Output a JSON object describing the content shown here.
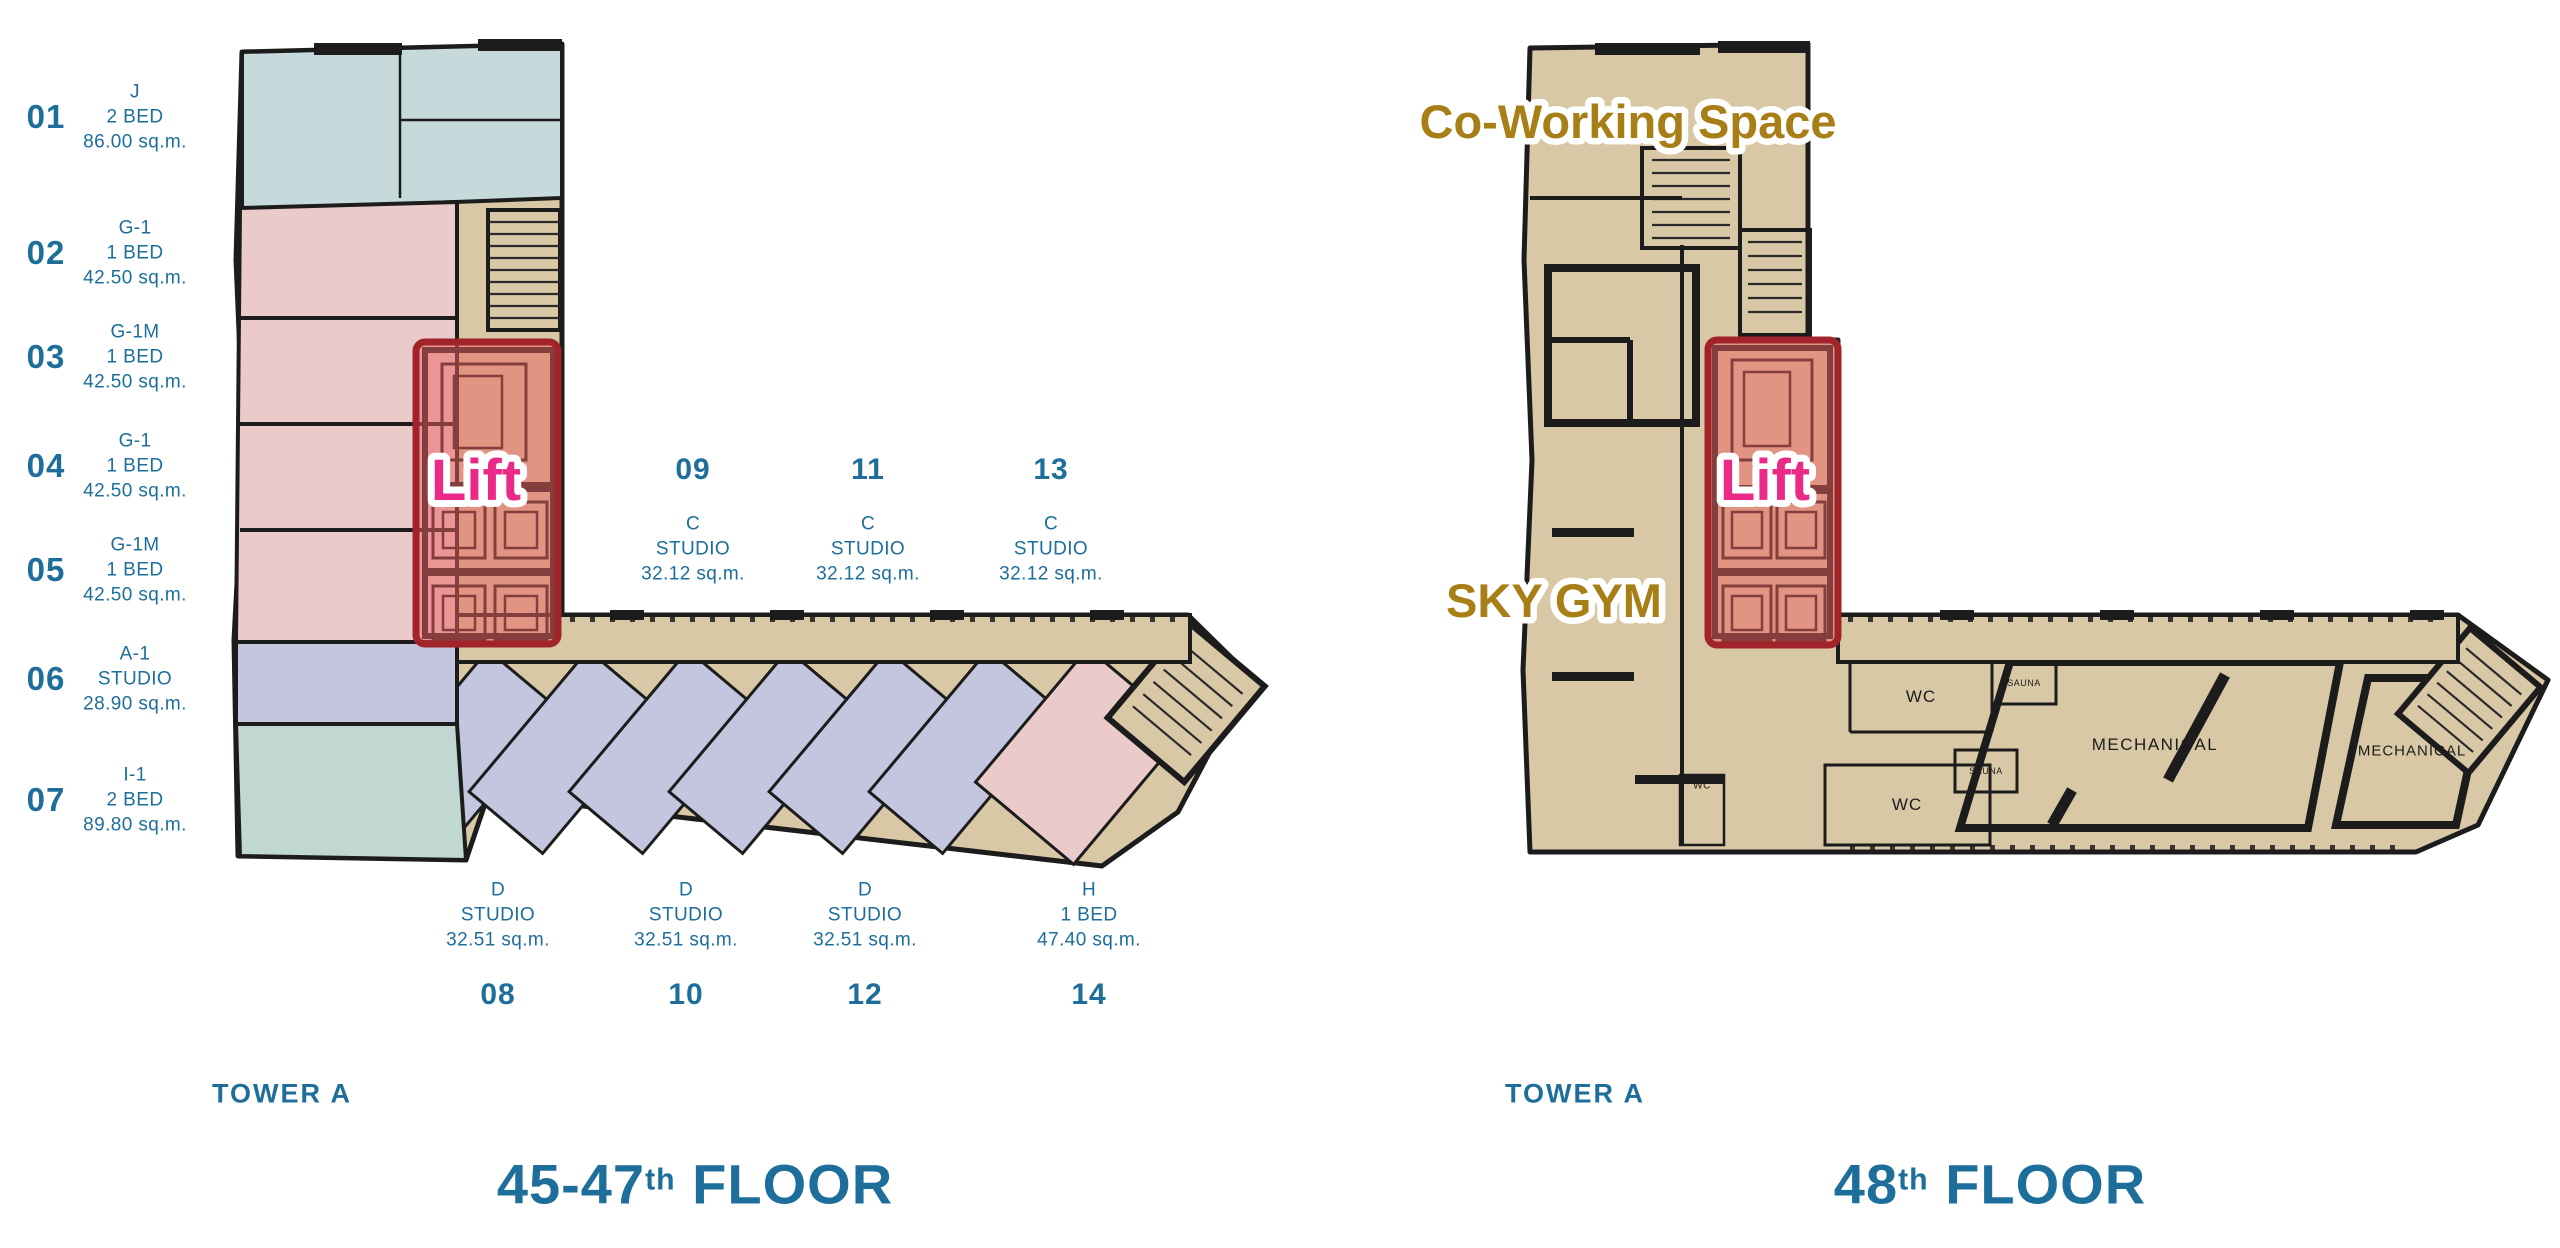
{
  "colors": {
    "text_teal": "#1d6e9b",
    "label_pink": "#ea2a86",
    "label_gold": "#a87e17",
    "label_outline": "#ffffff",
    "lift_box_fill": "#ec5f5f",
    "lift_box_border": "#a2242b",
    "plan_wall": "#1c1c1c",
    "plan_beige": "#d8c8a6",
    "unit_blue": "#c7dadb",
    "unit_pink": "#ebcbca",
    "unit_lavender": "#c4c5de",
    "unit_teal": "#c1d8d2",
    "room_gray": "#efeeec",
    "room_text": "#1c1c1c"
  },
  "left_panel": {
    "tower": "TOWER A",
    "floor_number": "45-47",
    "floor_suffix": "th",
    "floor_word": "FLOOR",
    "lift_label": "Lift",
    "side_units": [
      {
        "no": "01",
        "type": "J",
        "beds": "2 BED",
        "area": "86.00 sq.m."
      },
      {
        "no": "02",
        "type": "G-1",
        "beds": "1 BED",
        "area": "42.50 sq.m."
      },
      {
        "no": "03",
        "type": "G-1M",
        "beds": "1 BED",
        "area": "42.50 sq.m."
      },
      {
        "no": "04",
        "type": "G-1",
        "beds": "1 BED",
        "area": "42.50 sq.m."
      },
      {
        "no": "05",
        "type": "G-1M",
        "beds": "1 BED",
        "area": "42.50 sq.m."
      },
      {
        "no": "06",
        "type": "A-1",
        "beds": "STUDIO",
        "area": "28.90 sq.m."
      },
      {
        "no": "07",
        "type": "I-1",
        "beds": "2 BED",
        "area": "89.80 sq.m."
      }
    ],
    "top_units": [
      {
        "no": "09",
        "type": "C",
        "beds": "STUDIO",
        "area": "32.12 sq.m."
      },
      {
        "no": "11",
        "type": "C",
        "beds": "STUDIO",
        "area": "32.12 sq.m."
      },
      {
        "no": "13",
        "type": "C",
        "beds": "STUDIO",
        "area": "32.12 sq.m."
      }
    ],
    "bottom_units": [
      {
        "no": "08",
        "type": "D",
        "beds": "STUDIO",
        "area": "32.51 sq.m."
      },
      {
        "no": "10",
        "type": "D",
        "beds": "STUDIO",
        "area": "32.51 sq.m."
      },
      {
        "no": "12",
        "type": "D",
        "beds": "STUDIO",
        "area": "32.51 sq.m."
      },
      {
        "no": "14",
        "type": "H",
        "beds": "1 BED",
        "area": "47.40 sq.m."
      }
    ]
  },
  "right_panel": {
    "tower": "TOWER A",
    "floor_number": "48",
    "floor_suffix": "th",
    "floor_word": "FLOOR",
    "lift_label": "Lift",
    "amenities": {
      "coworking": "Co-Working Space",
      "sky_gym": "SKY GYM"
    },
    "rooms": {
      "wc_upper": "WC",
      "wc_lower": "WC",
      "wc_small": "WC",
      "sauna_upper": "SAUNA",
      "sauna_lower": "SAUNA",
      "mechanical_1": "MECHANICAL",
      "mechanical_2": "MECHANICAL"
    }
  }
}
